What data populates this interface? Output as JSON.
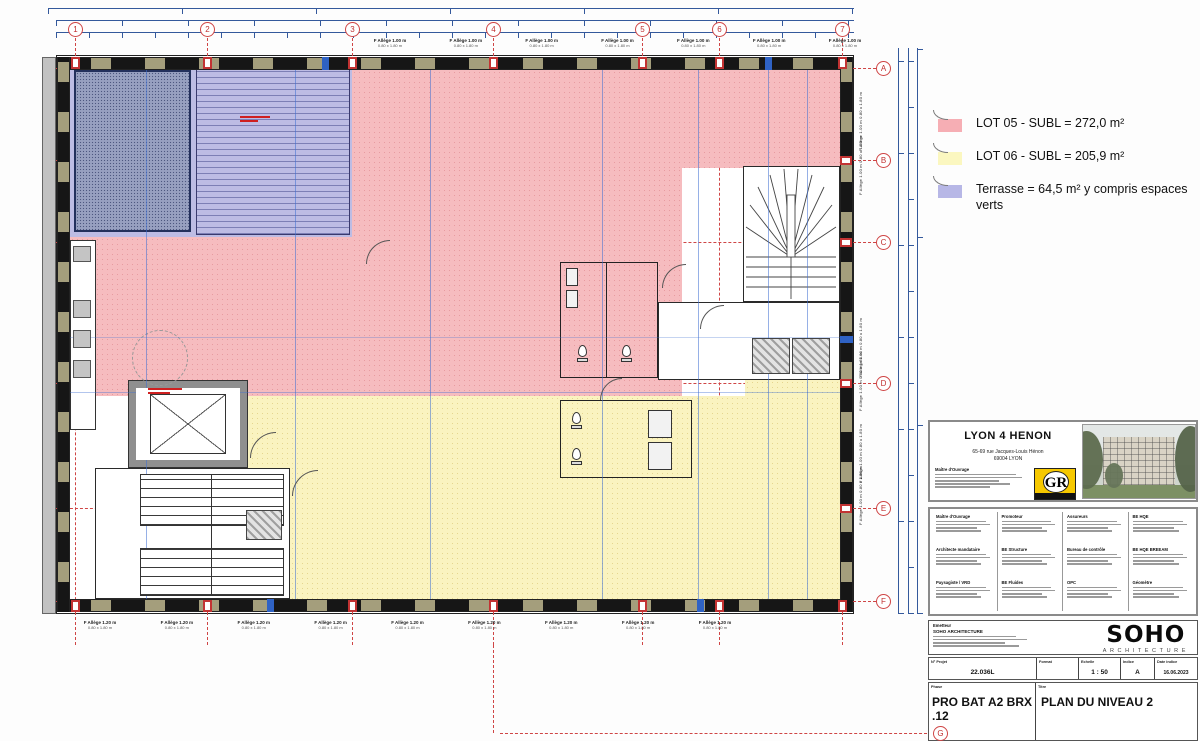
{
  "sheet": {
    "type": "architectural floor plan",
    "drawing_title": "PLAN DU NIVEAU 2",
    "phase": "PRO BAT A2 BRX .12"
  },
  "legend": {
    "items": [
      {
        "label": "LOT 05 - SUBL = 272,0 m²",
        "color": "#f6aeb4"
      },
      {
        "label": "LOT 06 - SUBL = 205,9 m²",
        "color": "#fbf7c0"
      },
      {
        "label": "Terrasse = 64,5 m² y compris espaces verts",
        "color": "#b7b7e6"
      }
    ]
  },
  "grid": {
    "top_bubbles": [
      "1",
      "2",
      "3",
      "4",
      "5",
      "6",
      "7"
    ],
    "side_bubbles": [
      "A",
      "B",
      "C",
      "D",
      "E",
      "F"
    ],
    "bottom_bubble": "G"
  },
  "windows": {
    "top_label": "F Allège 1.00 m",
    "top_dim": "0.80 x 1.80 m",
    "bottom_label": "F Allège 1.20 m",
    "bottom_dim": "0.80 x 1.80 m",
    "side_label": "F Allège 1.00 m",
    "side_dim": "0.80 x 1.80 m"
  },
  "titleblock": {
    "project_title": "LYON 4 HENON",
    "address_line1": "65-69 rue Jacques-Louis Hénon",
    "address_line2": "69004 LYON",
    "client_label": "Maître d'Ouvrage",
    "gr_logo_text": "GR",
    "contacts": [
      "Maître d'Ouvrage",
      "Promoteur",
      "Assureurs",
      "BE HQE",
      "Architecte mandataire",
      "BE Structure",
      "Bureau de contrôle",
      "BE HQE BREEAM",
      "Paysagiste / VRD",
      "BE Fluides",
      "OPC",
      "Géomètre"
    ],
    "emetteur_label": "Emetteur",
    "emetteur_name": "SOHO ARCHITECTURE",
    "soho_logo": "SOHO",
    "soho_logo_sub": "ARCHITECTURE",
    "fields": [
      {
        "label": "N° Projet",
        "value": "22.036L"
      },
      {
        "label": "Format",
        "value": ""
      },
      {
        "label": "Echelle",
        "value": "1 : 50"
      },
      {
        "label": "Indice",
        "value": "A"
      },
      {
        "label": "Date indice",
        "value": "16.06.2023"
      }
    ],
    "phase_label": "Phase",
    "phase_value": "PRO BAT A2 BRX .12",
    "title_label": "Titre",
    "title_value": "PLAN DU NIVEAU 2"
  },
  "colors": {
    "lot05_pink": "#f6bcbf",
    "lot06_yellow": "#faf3c0",
    "terrasse_lavender": "#bdbce4",
    "grid_red": "#cf4545",
    "dim_blue": "#34599c",
    "wall_olive": "#a49e7c"
  }
}
